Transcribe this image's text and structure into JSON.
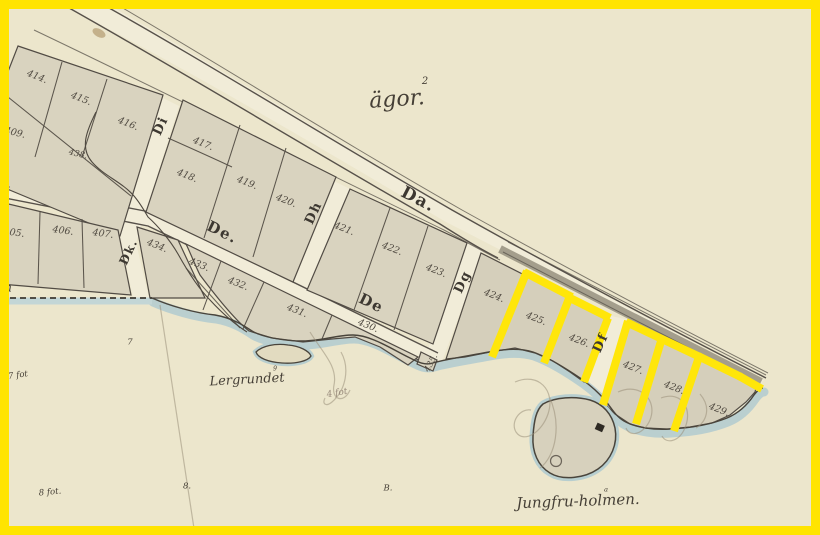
{
  "map": {
    "region_label": {
      "text": "ägor.",
      "superscript": "2",
      "x": 397,
      "y": 100,
      "rotate": -4,
      "size": 22
    },
    "street_labels": [
      {
        "id": "da",
        "text": "Da.",
        "x": 418,
        "y": 200,
        "rotate": 27,
        "size": 17
      },
      {
        "id": "de-west",
        "text": "De.",
        "x": 222,
        "y": 233,
        "rotate": 26,
        "size": 15
      },
      {
        "id": "de-east",
        "text": "De",
        "x": 371,
        "y": 304,
        "rotate": 26,
        "size": 15
      },
      {
        "id": "di",
        "text": "Di",
        "x": 161,
        "y": 126,
        "rotate": -65,
        "size": 13
      },
      {
        "id": "dk",
        "text": "Dk.",
        "x": 129,
        "y": 252,
        "rotate": -65,
        "size": 12
      },
      {
        "id": "dh",
        "text": "Dh",
        "x": 314,
        "y": 213,
        "rotate": -65,
        "size": 13
      },
      {
        "id": "dg",
        "text": "Dg",
        "x": 463,
        "y": 282,
        "rotate": -65,
        "size": 13
      },
      {
        "id": "df",
        "text": "Df",
        "x": 601,
        "y": 343,
        "rotate": -65,
        "size": 13
      }
    ],
    "edge_letters": [
      {
        "id": "d",
        "text": "d.",
        "x": 6,
        "y": 184,
        "rotate": 12,
        "size": 11
      },
      {
        "id": "n",
        "text": "n",
        "x": 8,
        "y": 288,
        "rotate": 0,
        "size": 12
      },
      {
        "id": "corner-7",
        "text": "7",
        "x": 4,
        "y": 12,
        "rotate": -15,
        "size": 13
      }
    ],
    "plot_numbers": [
      {
        "text": "405.",
        "x": 14,
        "y": 233,
        "rotate": 8
      },
      {
        "text": "406.",
        "x": 63,
        "y": 231,
        "rotate": 8
      },
      {
        "text": "407.",
        "x": 103,
        "y": 234,
        "rotate": 8
      },
      {
        "text": "409.",
        "x": 15,
        "y": 133,
        "rotate": 14
      },
      {
        "text": "414.",
        "x": 37,
        "y": 77,
        "rotate": 22
      },
      {
        "text": "415.",
        "x": 81,
        "y": 99,
        "rotate": 22
      },
      {
        "text": "416.",
        "x": 128,
        "y": 124,
        "rotate": 22
      },
      {
        "text": "417.",
        "x": 203,
        "y": 144,
        "rotate": 22
      },
      {
        "text": "418.",
        "x": 187,
        "y": 176,
        "rotate": 22
      },
      {
        "text": "419.",
        "x": 247,
        "y": 183,
        "rotate": 22
      },
      {
        "text": "420.",
        "x": 286,
        "y": 201,
        "rotate": 22
      },
      {
        "text": "421.",
        "x": 344,
        "y": 229,
        "rotate": 22
      },
      {
        "text": "422.",
        "x": 392,
        "y": 249,
        "rotate": 22
      },
      {
        "text": "423.",
        "x": 436,
        "y": 271,
        "rotate": 22
      },
      {
        "text": "424.",
        "x": 494,
        "y": 296,
        "rotate": 22
      },
      {
        "text": "425.",
        "x": 536,
        "y": 319,
        "rotate": 22
      },
      {
        "text": "426.",
        "x": 579,
        "y": 341,
        "rotate": 22
      },
      {
        "text": "427.",
        "x": 633,
        "y": 368,
        "rotate": 22
      },
      {
        "text": "428.",
        "x": 674,
        "y": 388,
        "rotate": 22
      },
      {
        "text": "429.",
        "x": 719,
        "y": 410,
        "rotate": 22
      },
      {
        "text": "430.",
        "x": 368,
        "y": 326,
        "rotate": 22
      },
      {
        "text": "431.",
        "x": 297,
        "y": 311,
        "rotate": 22
      },
      {
        "text": "432.",
        "x": 238,
        "y": 284,
        "rotate": 22
      },
      {
        "text": "433.",
        "x": 199,
        "y": 265,
        "rotate": 22
      },
      {
        "text": "434.",
        "x": 157,
        "y": 246,
        "rotate": 22
      },
      {
        "text": "435.",
        "x": 431,
        "y": 363,
        "rotate": -62,
        "size": 8.5
      },
      {
        "text": "438.",
        "x": 78,
        "y": 154,
        "rotate": 14,
        "size": 8.5
      }
    ],
    "place_labels": [
      {
        "id": "lergrundet",
        "text": "Lergrundet",
        "superscript": "9",
        "x": 247,
        "y": 380,
        "rotate": -3,
        "size": 13
      },
      {
        "id": "jungfruholmen",
        "text": "Jungfru-holmen.",
        "superscript": "a",
        "x": 578,
        "y": 502,
        "rotate": -2,
        "size": 15
      }
    ],
    "depth_notes": [
      {
        "id": "7-fot",
        "text": "7 fot",
        "x": 18,
        "y": 375,
        "rotate": -8,
        "size": 8.5
      },
      {
        "id": "seven",
        "text": "7",
        "x": 130,
        "y": 342,
        "rotate": 0,
        "size": 8.5
      },
      {
        "id": "8-fot",
        "text": "8 fot.",
        "x": 50,
        "y": 492,
        "rotate": -5,
        "size": 8.5
      },
      {
        "id": "eight",
        "text": "8.",
        "x": 187,
        "y": 486,
        "rotate": 0,
        "size": 8.5
      },
      {
        "id": "b-mark",
        "text": "B.",
        "x": 388,
        "y": 488,
        "rotate": 0,
        "size": 8.5
      }
    ],
    "pencil_notes": [
      {
        "id": "4-fot",
        "text": "4 fot",
        "x": 337,
        "y": 393,
        "rotate": -10,
        "size": 9
      }
    ],
    "highlight": {
      "color": "#ffe60a",
      "highlighted_plots": [
        "425",
        "426",
        "427",
        "428",
        "429"
      ],
      "segments": [
        [
          527,
          271,
          492,
          357
        ],
        [
          524,
          272,
          572,
          297
        ],
        [
          570,
          296,
          544,
          363
        ],
        [
          568,
          297,
          610,
          318
        ],
        [
          608,
          318,
          584,
          382
        ],
        [
          628,
          321,
          603,
          405
        ],
        [
          626,
          322,
          700,
          357
        ],
        [
          662,
          338,
          636,
          424
        ],
        [
          698,
          356,
          741,
          377
        ],
        [
          699,
          357,
          674,
          431
        ],
        [
          739,
          376,
          762,
          389
        ]
      ]
    },
    "colors": {
      "frame": "#ffe400",
      "water": "#b7cecf",
      "parchment": "#eae3c8",
      "block": "#d9d3bf",
      "street": "#f1ecd8",
      "ink": "#57514a",
      "pencil": "#9a8f7a"
    }
  }
}
